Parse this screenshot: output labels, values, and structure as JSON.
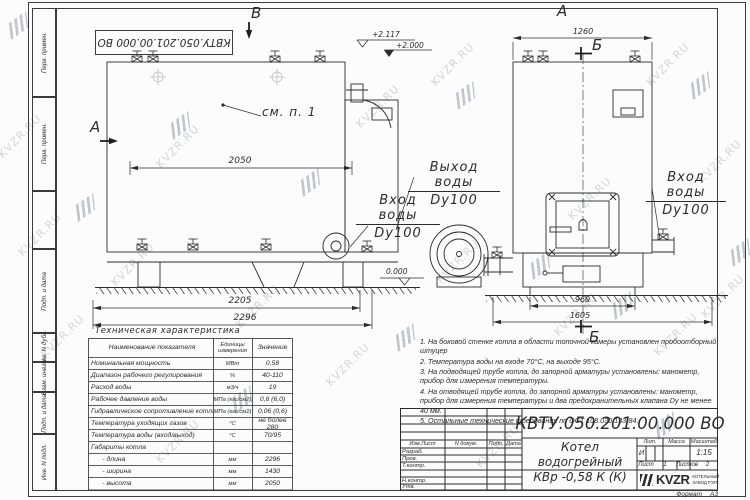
{
  "watermark": {
    "text": "KVZR.RU"
  },
  "stamp": {
    "code": "КВТУ.050.201.00.000  ВО"
  },
  "margin": {
    "items": [
      "Перв. примен.",
      "Перв. примен.",
      "Подп. и дата",
      "Инв. N дубл.",
      "Взам. инв. N",
      "Подп. и дата",
      "Инв. N подл."
    ]
  },
  "drawing": {
    "section_a": "А",
    "section_b": "Б",
    "section_v": "В",
    "see_note": "см. п. 1",
    "dims": {
      "d2050": "2050",
      "d2205": "2205",
      "d2296": "2296",
      "d1260": "1260",
      "d960": "960",
      "d1605": "1605"
    },
    "levels": {
      "top": "+2.117",
      "second": "+2.000",
      "zero": "0.000"
    },
    "labels": {
      "outlet_line1": "Выход воды",
      "outlet_line2": "Dy100",
      "inlet_line1": "Вход воды",
      "inlet_line2": "Dy100",
      "inlet_right_line1": "Вход воды",
      "inlet_right_line2": "Dy100"
    }
  },
  "tech_table": {
    "title": "Техническая характеристика",
    "headers": {
      "name": "Наименование показателя",
      "units": "Единицы измерения",
      "value": "Значение"
    },
    "rows": [
      {
        "name": "Номинальная мощность",
        "units": "МВт",
        "value": "0,58"
      },
      {
        "name": "Диапазон рабочего регулирования",
        "units": "%",
        "value": "40-110"
      },
      {
        "name": "Расход воды",
        "units": "м3/ч",
        "value": "19"
      },
      {
        "name": "Рабочее давление воды",
        "units": "МПа (кгс/см2)",
        "value": "0,6 (6,0)"
      },
      {
        "name": "Гидравлическое сопротивление котла",
        "units": "МПа (кгс/см2)",
        "value": "0,06 (0,6)"
      },
      {
        "name": "Температура уходящих газов",
        "units": "°С",
        "value": "не более 280"
      },
      {
        "name": "Температура воды (вход/выход)",
        "units": "°С",
        "value": "70/95"
      },
      {
        "name": "Габариты котла",
        "units": "",
        "value": ""
      },
      {
        "name": "      - длина",
        "units": "мм",
        "value": "2296"
      },
      {
        "name": "      - ширина",
        "units": "мм",
        "value": "1430"
      },
      {
        "name": "      - высота",
        "units": "мм",
        "value": "2050"
      }
    ]
  },
  "notes": {
    "items": [
      "1.  На боковой стенке котла в области топочной камеры установлен пробоотборный штуцер",
      "2.  Температура воды на входе 70°С, на выходе 95°С.",
      "3.  На подводящей трубе котла, до запорной арматуры установлены: манометр, прибор для измерения температуры.",
      "4.  На отводящей трубе котла, до запорной арматуры установлены: манометр, прибор для измерения температуры и два предохранительных клапана Dу не менее 40 мм.",
      "5.  Остальные технические требования по ОСТ 108.030.133-84."
    ]
  },
  "title_block": {
    "doc_number": "КВТУ.050.201.00.000  ВО",
    "product_line1": "Котел водогрейный",
    "product_line2": "КВр -0,58  К  (К)",
    "header_cols": {
      "izm": "Изм.Лист",
      "doc": "N докум.",
      "sign": "Подп.",
      "date": "Дата"
    },
    "roles": [
      "Разраб.",
      "Пров.",
      "Т.контр.",
      "Н.контр.",
      "Утв."
    ],
    "lit_label": "Лит.",
    "mass_label": "Масса",
    "scale_label": "Масштаб",
    "lit_value": "И",
    "scale_value": "1:15",
    "sheet_label": "Лист",
    "sheet_value": "1",
    "sheets_label": "Листов",
    "sheets_value": "2",
    "logo_text": "KVZR",
    "logo_sub1": "КОТЕЛЬНЫЙ",
    "logo_sub2": "ЗАВОД РЭП",
    "format_label": "Формат",
    "format_value": "А3"
  }
}
